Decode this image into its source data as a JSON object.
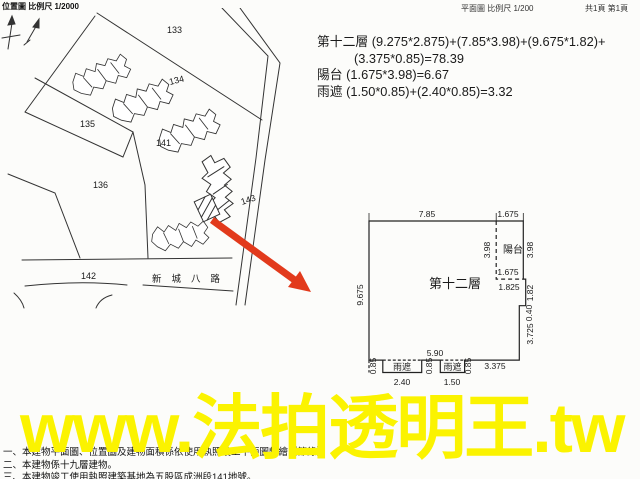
{
  "header": {
    "location_map": "位置圖 比例尺  1/2000",
    "floor_plan_scale": "平面圖 比例尺  1/200",
    "pages": "共1頁 第1頁"
  },
  "calc": {
    "lines": [
      "第十二層 (9.275*2.875)+(7.85*3.98)+(9.675*1.82)+",
      "(3.375*0.85)=78.39",
      "陽台 (1.675*3.98)=6.67",
      "雨遮 (1.50*0.85)+(2.40*0.85)=3.32"
    ]
  },
  "site_map": {
    "north_label": "N",
    "parcels": [
      "133",
      "134",
      "135",
      "136",
      "141",
      "142",
      "143"
    ],
    "road_name": "新城八路"
  },
  "floor_plan": {
    "room_label": "第十二層",
    "balcony_label": "陽台",
    "eave1_label": "雨遮",
    "eave2_label": "雨遮",
    "dims": {
      "top_main": "7.85",
      "top_balcony": "1.675",
      "left_side": "9.675",
      "balcony_depth_left": "3.98",
      "balcony_depth_right": "3.98",
      "balcony_bottom": "1.675",
      "below_balcony": "1.825",
      "right_upper": "1.82",
      "right_step": "0.40",
      "right_lower": "3.725",
      "bottom_right": "3.375",
      "bottom_span": "5.90",
      "eave1_width": "2.40",
      "eave2_width": "1.50",
      "eave_h_left": "0.85",
      "eave_h_mid": "0.85",
      "eave_h_right": "0.85"
    }
  },
  "notes": [
    "一、本建物平面圖、位置圖及建物面積係依使用執照竣工平面圖轉繪（節錄）。",
    "二、本建物係十九層建物。",
    "三、本建物竣工使用執照建築基地為五股區成洲段141地號。"
  ],
  "watermark": {
    "text": "www.法拍透明王.tw",
    "color": "#fbf300"
  },
  "colors": {
    "arrow": "#e23a1c",
    "line": "#333333"
  }
}
